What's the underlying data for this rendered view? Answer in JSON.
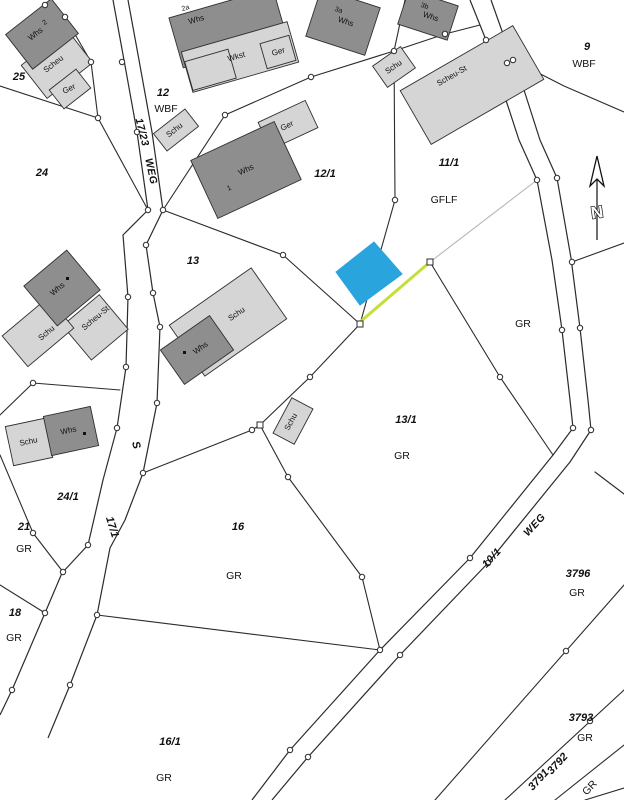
{
  "map": {
    "type": "cadastral-parcel-map",
    "north_label": "N",
    "colors": {
      "background": "#ffffff",
      "boundary_line": "#2b2b2b",
      "gray_line": "#b5b5b5",
      "building_dark": "#8e8e8e",
      "building_light": "#d5d5d5",
      "highlight_parcel_fill": "#29a4dd",
      "highlight_boundary_line": "#c6de3a",
      "survey_marker_fill": "#ffffff"
    },
    "labels": [
      {
        "name": "parcel-label-25",
        "text": "25",
        "x": 19,
        "y": 80,
        "rot": 0,
        "cls": "lbl-parcel"
      },
      {
        "name": "parcel-label-24",
        "text": "24",
        "x": 42,
        "y": 176,
        "rot": 0,
        "cls": "lbl-parcel"
      },
      {
        "name": "parcel-label-12",
        "text": "12",
        "x": 163,
        "y": 96,
        "rot": 0,
        "cls": "lbl-parcel"
      },
      {
        "name": "parcel-label-12-1",
        "text": "12/1",
        "x": 325,
        "y": 177,
        "rot": 0,
        "cls": "lbl-parcel"
      },
      {
        "name": "parcel-label-11-1",
        "text": "11/1",
        "x": 449,
        "y": 166,
        "rot": 0,
        "cls": "lbl-parcel"
      },
      {
        "name": "parcel-label-9",
        "text": "9",
        "x": 587,
        "y": 50,
        "rot": 0,
        "cls": "lbl-parcel"
      },
      {
        "name": "parcel-label-13",
        "text": "13",
        "x": 193,
        "y": 264,
        "rot": 0,
        "cls": "lbl-parcel"
      },
      {
        "name": "parcel-label-13-1",
        "text": "13/1",
        "x": 406,
        "y": 423,
        "rot": 0,
        "cls": "lbl-parcel"
      },
      {
        "name": "parcel-label-24-1",
        "text": "24/1",
        "x": 68,
        "y": 500,
        "rot": 0,
        "cls": "lbl-parcel"
      },
      {
        "name": "parcel-label-21",
        "text": "21",
        "x": 24,
        "y": 530,
        "rot": 0,
        "cls": "lbl-parcel"
      },
      {
        "name": "parcel-label-16",
        "text": "16",
        "x": 238,
        "y": 530,
        "rot": 0,
        "cls": "lbl-parcel"
      },
      {
        "name": "parcel-label-18",
        "text": "18",
        "x": 15,
        "y": 616,
        "rot": 0,
        "cls": "lbl-parcel"
      },
      {
        "name": "parcel-label-16-1",
        "text": "16/1",
        "x": 170,
        "y": 745,
        "rot": 0,
        "cls": "lbl-parcel"
      },
      {
        "name": "parcel-label-3796",
        "text": "3796",
        "x": 578,
        "y": 577,
        "rot": 0,
        "cls": "lbl-parcel"
      },
      {
        "name": "parcel-label-3793",
        "text": "3793",
        "x": 581,
        "y": 721,
        "rot": 0,
        "cls": "lbl-parcel"
      },
      {
        "name": "parcel-label-3792",
        "text": "3792",
        "x": 560,
        "y": 766,
        "rot": -47,
        "cls": "lbl-parcel"
      },
      {
        "name": "parcel-label-3791",
        "text": "3791",
        "x": 541,
        "y": 782,
        "rot": -47,
        "cls": "lbl-parcel"
      },
      {
        "name": "parcel-label-17-1",
        "text": "17/1",
        "x": 109,
        "y": 528,
        "rot": 73,
        "cls": "lbl-parcel"
      },
      {
        "name": "parcel-label-s",
        "text": "S",
        "x": 133,
        "y": 446,
        "rot": 73,
        "cls": "lbl-parcel"
      },
      {
        "name": "landuse-label-wbf-12",
        "text": "WBF",
        "x": 166,
        "y": 112,
        "rot": 0,
        "cls": "lbl-use"
      },
      {
        "name": "landuse-label-wbf-9",
        "text": "WBF",
        "x": 584,
        "y": 67,
        "rot": 0,
        "cls": "lbl-use"
      },
      {
        "name": "landuse-label-gflf",
        "text": "GFLF",
        "x": 444,
        "y": 203,
        "rot": 0,
        "cls": "lbl-use"
      },
      {
        "name": "landuse-label-gr-east",
        "text": "GR",
        "x": 523,
        "y": 327,
        "rot": 0,
        "cls": "lbl-use"
      },
      {
        "name": "landuse-label-gr-13-1",
        "text": "GR",
        "x": 402,
        "y": 459,
        "rot": 0,
        "cls": "lbl-use"
      },
      {
        "name": "landuse-label-gr-21",
        "text": "GR",
        "x": 24,
        "y": 552,
        "rot": 0,
        "cls": "lbl-use"
      },
      {
        "name": "landuse-label-gr-16",
        "text": "GR",
        "x": 234,
        "y": 579,
        "rot": 0,
        "cls": "lbl-use"
      },
      {
        "name": "landuse-label-gr-18",
        "text": "GR",
        "x": 14,
        "y": 641,
        "rot": 0,
        "cls": "lbl-use"
      },
      {
        "name": "landuse-label-gr-16-1",
        "text": "GR",
        "x": 164,
        "y": 781,
        "rot": 0,
        "cls": "lbl-use"
      },
      {
        "name": "landuse-label-gr-3796",
        "text": "GR",
        "x": 577,
        "y": 596,
        "rot": 0,
        "cls": "lbl-use"
      },
      {
        "name": "landuse-label-gr-3793",
        "text": "GR",
        "x": 585,
        "y": 741,
        "rot": 0,
        "cls": "lbl-use"
      },
      {
        "name": "landuse-label-gr-3791",
        "text": "GR",
        "x": 592,
        "y": 790,
        "rot": -47,
        "cls": "lbl-use"
      },
      {
        "name": "road-label-17-23",
        "text": "17/23",
        "x": 139,
        "y": 133,
        "rot": 76,
        "cls": "lbl-road"
      },
      {
        "name": "road-label-weg-west",
        "text": "WEG",
        "x": 148,
        "y": 172,
        "rot": 78,
        "cls": "lbl-road"
      },
      {
        "name": "road-label-10-1",
        "text": "10/1",
        "x": 494,
        "y": 560,
        "rot": -47,
        "cls": "lbl-road"
      },
      {
        "name": "road-label-weg-east",
        "text": "WEG",
        "x": 537,
        "y": 527,
        "rot": -47,
        "cls": "lbl-road"
      },
      {
        "name": "building-label-whs-25",
        "text": "Whs",
        "x": 37,
        "y": 36,
        "rot": -38,
        "cls": "lbl-bldg"
      },
      {
        "name": "building-number-2",
        "text": "2",
        "x": 46,
        "y": 24,
        "rot": -38,
        "cls": "lbl-tiny"
      },
      {
        "name": "building-label-scheu-25",
        "text": "Scheu",
        "x": 55,
        "y": 66,
        "rot": -38,
        "cls": "lbl-bldg"
      },
      {
        "name": "building-label-ger-25",
        "text": "Ger",
        "x": 70,
        "y": 91,
        "rot": -25,
        "cls": "lbl-bldg"
      },
      {
        "name": "building-number-2a",
        "text": "2a",
        "x": 186,
        "y": 10,
        "rot": -16,
        "cls": "lbl-tiny"
      },
      {
        "name": "building-label-whs-12",
        "text": "Whs",
        "x": 197,
        "y": 22,
        "rot": -16,
        "cls": "lbl-bldg"
      },
      {
        "name": "building-label-wkst",
        "text": "Wkst",
        "x": 237,
        "y": 59,
        "rot": -16,
        "cls": "lbl-bldg"
      },
      {
        "name": "building-label-ger-12",
        "text": "Ger",
        "x": 279,
        "y": 54,
        "rot": -16,
        "cls": "lbl-bldg"
      },
      {
        "name": "building-number-3a",
        "text": "3a",
        "x": 338,
        "y": 12,
        "rot": 18,
        "cls": "lbl-tiny"
      },
      {
        "name": "building-label-whs-3a",
        "text": "Whs",
        "x": 345,
        "y": 24,
        "rot": 18,
        "cls": "lbl-bldg"
      },
      {
        "name": "building-number-3b",
        "text": "3b",
        "x": 424,
        "y": 8,
        "rot": 18,
        "cls": "lbl-tiny"
      },
      {
        "name": "building-label-whs-3b",
        "text": "Whs",
        "x": 430,
        "y": 19,
        "rot": 18,
        "cls": "lbl-bldg"
      },
      {
        "name": "building-label-schu-top",
        "text": "Schu",
        "x": 395,
        "y": 69,
        "rot": -35,
        "cls": "lbl-bldg"
      },
      {
        "name": "building-label-scheu-st-top",
        "text": "Scheu-St",
        "x": 453,
        "y": 78,
        "rot": -30,
        "cls": "lbl-bldg"
      },
      {
        "name": "building-label-schu-12",
        "text": "Schu",
        "x": 176,
        "y": 132,
        "rot": -38,
        "cls": "lbl-bldg"
      },
      {
        "name": "building-label-whs-12-1",
        "text": "Whs",
        "x": 247,
        "y": 172,
        "rot": -25,
        "cls": "lbl-bldg"
      },
      {
        "name": "building-number-1",
        "text": "1",
        "x": 230,
        "y": 190,
        "rot": -25,
        "cls": "lbl-tiny"
      },
      {
        "name": "building-label-ger-12-1",
        "text": "Ger",
        "x": 288,
        "y": 128,
        "rot": -25,
        "cls": "lbl-bldg"
      },
      {
        "name": "building-label-whs-13w",
        "text": "Whs",
        "x": 59,
        "y": 291,
        "rot": -40,
        "cls": "lbl-bldg"
      },
      {
        "name": "building-label-scheu-st-13w",
        "text": "Scheu-St",
        "x": 97,
        "y": 320,
        "rot": -40,
        "cls": "lbl-bldg"
      },
      {
        "name": "building-label-schu-13w",
        "text": "Schu",
        "x": 48,
        "y": 335,
        "rot": -40,
        "cls": "lbl-bldg"
      },
      {
        "name": "building-label-schu-13",
        "text": "Schu",
        "x": 238,
        "y": 316,
        "rot": -35,
        "cls": "lbl-bldg"
      },
      {
        "name": "building-label-whs-13",
        "text": "Whs",
        "x": 202,
        "y": 350,
        "rot": -35,
        "cls": "lbl-bldg"
      },
      {
        "name": "building-label-schu-13-1",
        "text": "Schu",
        "x": 293,
        "y": 423,
        "rot": -62,
        "cls": "lbl-bldg"
      },
      {
        "name": "building-label-schu-24-1",
        "text": "Schu",
        "x": 29,
        "y": 444,
        "rot": -12,
        "cls": "lbl-bldg"
      },
      {
        "name": "building-label-whs-24-1",
        "text": "Whs",
        "x": 69,
        "y": 433,
        "rot": -12,
        "cls": "lbl-bldg"
      }
    ]
  }
}
